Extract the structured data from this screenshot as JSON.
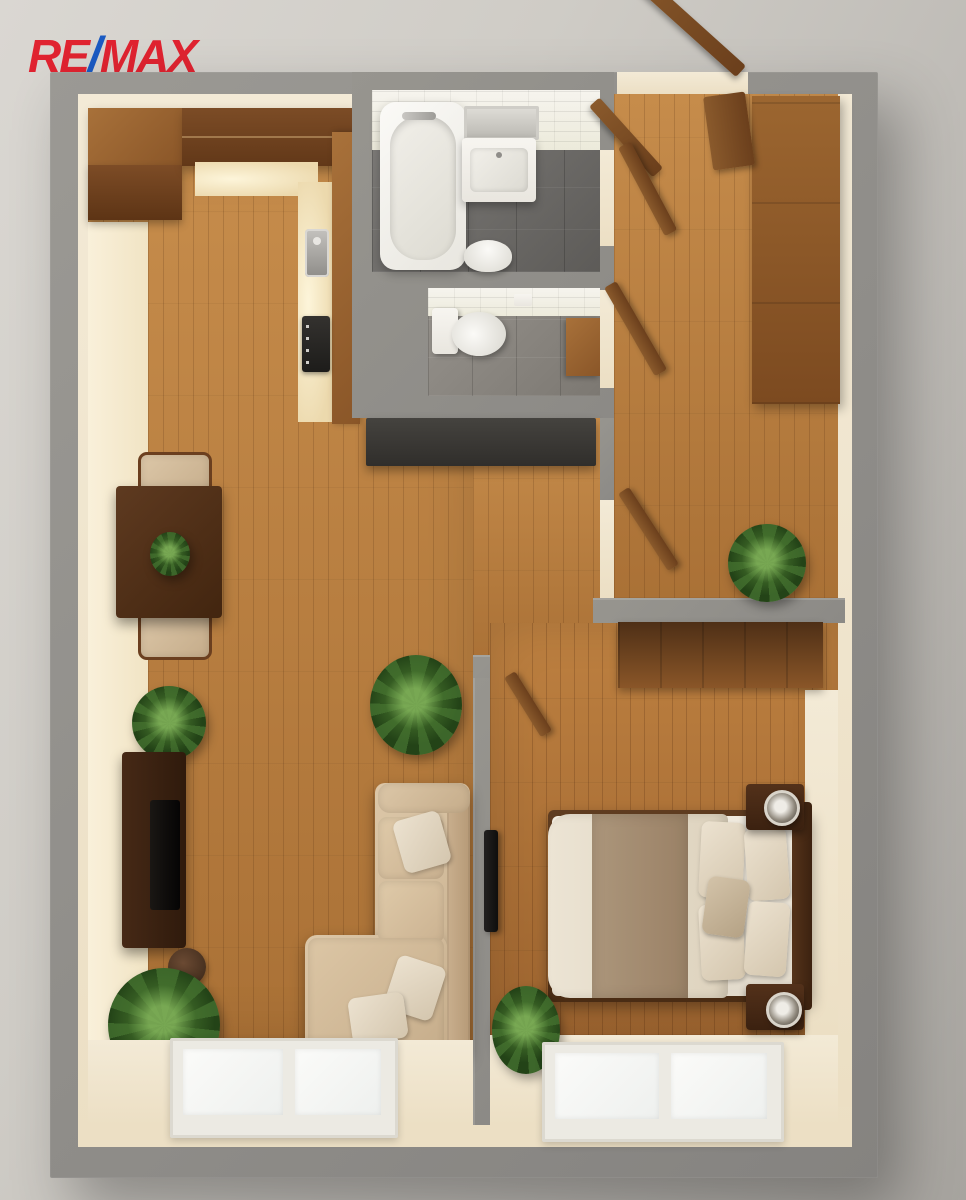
{
  "brand": {
    "re": "RE",
    "slash": "/",
    "max": "MAX",
    "red": "#e02330",
    "blue": "#1b5ac2"
  },
  "palette": {
    "background": "#cfccc6",
    "wall_gray": "#8f8d89",
    "inner_wall_cream": "#f1e8d3",
    "floor_wood": "#b97c42",
    "bathroom_tile": "#f3f1ea",
    "slate_floor": "#6e6c6a",
    "sofa_beige": "#cdb497",
    "bed_linen": "#eae2d3",
    "plant_green": "#2f5220",
    "counter_dark": "#3c3a37"
  },
  "scene": {
    "type": "3d-floor-plan-top-view",
    "rooms": [
      "living-room-with-kitchen",
      "bathroom",
      "wc",
      "hallway",
      "bedroom"
    ],
    "furniture": [
      "kitchen-cabinets",
      "sink",
      "stove",
      "dining-table",
      "dining-chairs",
      "tv-sideboard",
      "sofa",
      "bathtub",
      "vanity-sink",
      "toilet",
      "hall-wardrobe",
      "bedroom-wardrobe",
      "double-bed",
      "nightstands",
      "lamps",
      "plants",
      "windows",
      "sideboard-desk"
    ]
  }
}
